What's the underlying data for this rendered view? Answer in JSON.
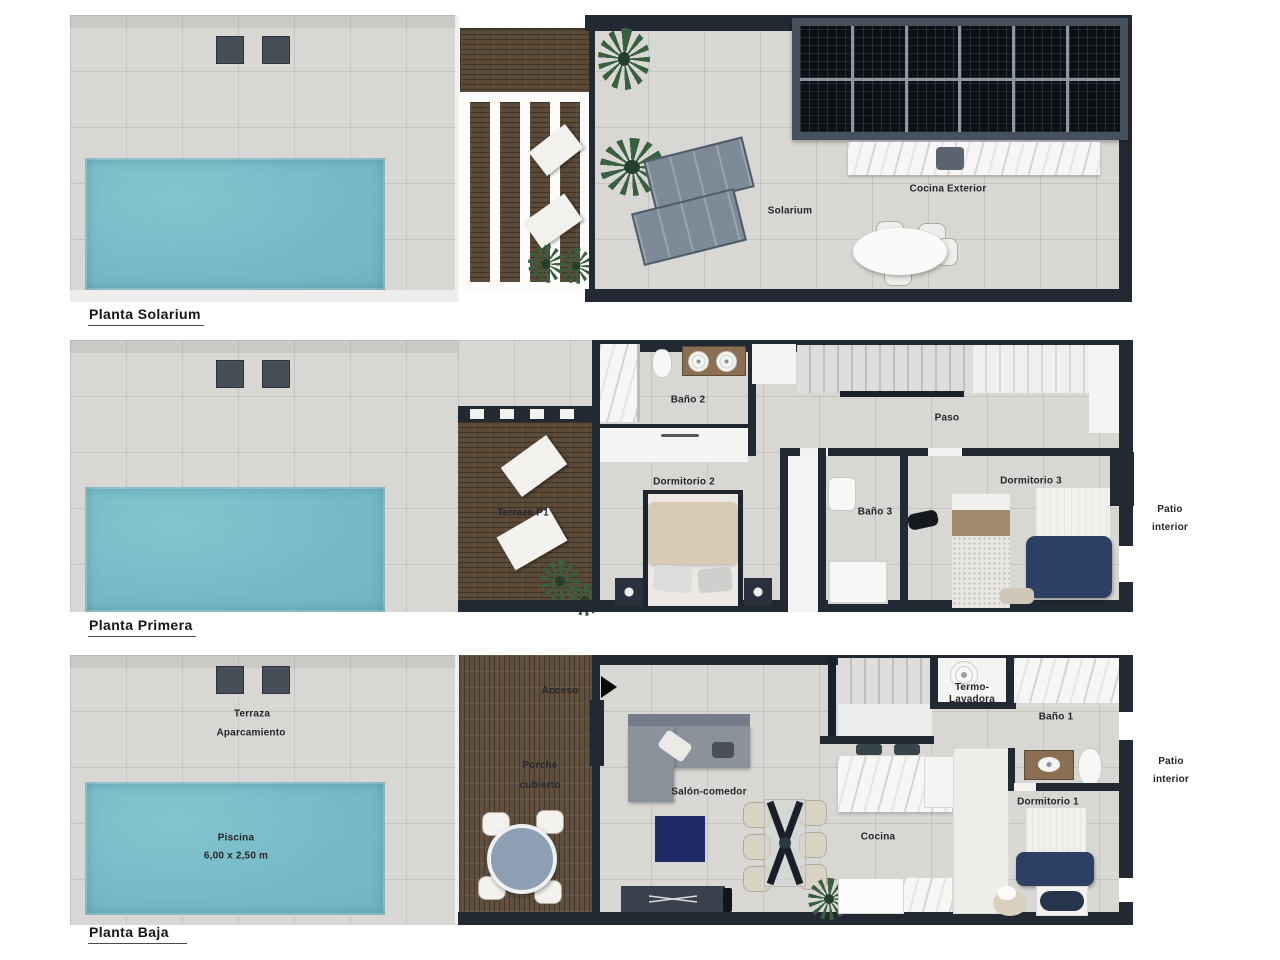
{
  "colors": {
    "pool_water": "#76bac8",
    "wood_deck": "#5a4936",
    "wall": "#232932",
    "tile_floor": "#d8d7d4",
    "accent_navy": "#2d3f63"
  },
  "plans": {
    "solarium": {
      "title": "Planta Solarium",
      "labels": {
        "solarium": "Solarium",
        "cocina_exterior": "Cocina Exterior"
      }
    },
    "primera": {
      "title": "Planta Primera",
      "labels": {
        "bano2": "Baño 2",
        "paso": "Paso",
        "terraza_p1": "Terraza P1",
        "dormitorio2": "Dormitorio 2",
        "bano3": "Baño 3",
        "dormitorio3": "Dormitorio 3",
        "patio_interior": "Patio\ninterior"
      }
    },
    "baja": {
      "title": "Planta Baja",
      "labels": {
        "terraza": "Terraza",
        "aparcamiento": "Aparcamiento",
        "piscina": "Piscina",
        "piscina_dimensiones": "6,00 x 2,50 m",
        "acceso": "Acceso",
        "porche_cubierto": "Porche\ncubierto",
        "salon_comedor": "Salón-comedor",
        "termo_lavadora": "Termo-\nLavadora",
        "bano1": "Baño 1",
        "cocina": "Cocina",
        "dormitorio1": "Dormitorio 1",
        "patio_interior": "Patio\ninterior"
      }
    }
  }
}
